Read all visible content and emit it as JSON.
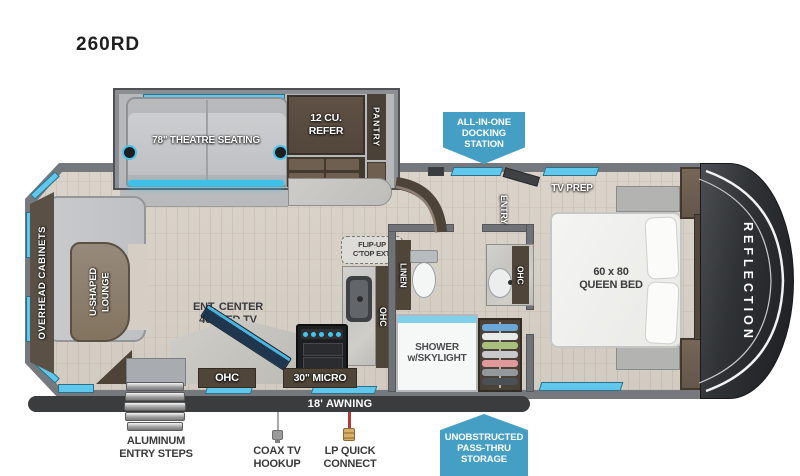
{
  "title": "260RD",
  "colors": {
    "callout_blue": "#459fc4",
    "window_blue": "#5fc8ec",
    "awning_dark": "#3a3c3e",
    "wall_gray": "#75787c",
    "dark_wood": "#4f4539",
    "floor_wood": "#d7d0c7",
    "led_accent": "#3fc0e8"
  },
  "callouts": {
    "docking": "ALL-IN-ONE\nDOCKING\nSTATION",
    "storage": "UNOBSTRUCTED\nPASS-THRU\nSTORAGE"
  },
  "slide": {
    "theatre": "78\" THEATRE SEATING",
    "refer": "12 CU.\nREFER",
    "pantry": "PANTRY"
  },
  "living": {
    "overhead_cabinets": "OVERHEAD CABINETS",
    "lounge": "U-SHAPED\nLOUNGE",
    "ent_center": "ENT. CENTER\n40\" LED TV",
    "ohc_band": "OHC"
  },
  "kitchen": {
    "flip_up": "FLIP-UP\nC'TOP EXT.",
    "ohc": "OHC",
    "micro": "30\" MICRO"
  },
  "bath": {
    "linen": "LINEN",
    "shower": "SHOWER\nw/SKYLIGHT",
    "ohc": "OHC"
  },
  "bedroom": {
    "entry": "ENTRY",
    "tv_prep": "TV PREP",
    "bed": "60 x 80\nQUEEN BED",
    "overhead_cabinets": "OVERHEAD CABINETS"
  },
  "exterior": {
    "reflection": "REFLECTION",
    "awning": "18' AWNING",
    "steps": "ALUMINUM\nENTRY STEPS",
    "coax": "COAX TV\nHOOKUP",
    "lp": "LP QUICK\nCONNECT"
  }
}
